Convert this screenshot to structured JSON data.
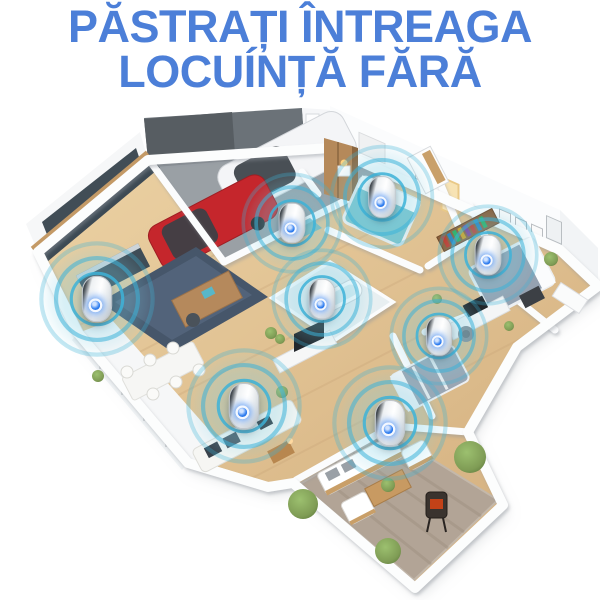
{
  "title": {
    "line1": "PĂSTRAȚI ÎNTREAGA",
    "line2": "LOCUÍNȚĂ FĂRĂ",
    "color": "#4c7fd8"
  },
  "scene": {
    "type": "isometric-home-cutaway-render",
    "rooms": [
      "garage",
      "entry-hallway",
      "kitchen",
      "dining-area",
      "living-room",
      "master-bedroom",
      "right-bedroom",
      "center-bathroom",
      "home-office",
      "second-bedroom",
      "patio",
      "terrace"
    ],
    "vehicles": [
      "white-suv",
      "red-car"
    ],
    "device_label": "ultrasonic-pest-repeller"
  },
  "devices": [
    {
      "room": "entry-hallway",
      "x": 292,
      "y": 223,
      "scale": 0.92
    },
    {
      "room": "master-bedroom",
      "x": 382,
      "y": 197,
      "scale": 0.95
    },
    {
      "room": "right-bedroom",
      "x": 488,
      "y": 255,
      "scale": 0.92
    },
    {
      "room": "kitchen",
      "x": 97,
      "y": 299,
      "scale": 1.05
    },
    {
      "room": "center-bathroom",
      "x": 322,
      "y": 299,
      "scale": 0.92
    },
    {
      "room": "living-room",
      "x": 244,
      "y": 406,
      "scale": 1.05
    },
    {
      "room": "patio",
      "x": 390,
      "y": 423,
      "scale": 1.05
    },
    {
      "room": "home-office",
      "x": 439,
      "y": 336,
      "scale": 0.9
    }
  ],
  "colors": {
    "title_blue": "#4c7fd8",
    "ripple_cyan": "#3db3d8",
    "device_led_blue": "#2f7ef0",
    "wood_floor": "#ddbf94",
    "garage_floor": "#9aa0a5",
    "patio_rug": "#b2a496",
    "navy_rug": "#46566a",
    "red_car": "#c5262c",
    "white_car": "#f4f5f7",
    "plant_green": "#7f9c55",
    "background": "#ffffff"
  }
}
